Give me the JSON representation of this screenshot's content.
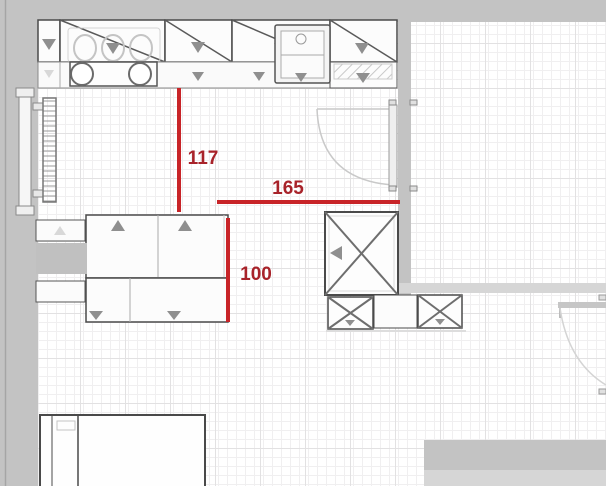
{
  "plan": {
    "dimensions": [
      {
        "label": "117",
        "value": 117,
        "orientation": "vertical"
      },
      {
        "label": "165",
        "value": 165,
        "orientation": "horizontal"
      },
      {
        "label": "100",
        "value": 100,
        "orientation": "vertical"
      }
    ],
    "colors": {
      "dim_line": "#c82428",
      "dim_text": "#a8232a",
      "wall": "#c3c3c3",
      "wall_light": "#d6d6d6",
      "outline_dark": "#4a4a4a",
      "outline_mid": "#8f8f8f",
      "grid_minor": "#f0eff0",
      "grid_major": "#e2e1e2"
    },
    "objects": [
      "top-wall",
      "left-wall",
      "inner-vertical-wall",
      "inner-horizontal-wall",
      "wall-cabinet-row",
      "base-cabinet-row",
      "cooktop",
      "sink",
      "hatched-cabinet",
      "window",
      "radiator",
      "kitchen-island",
      "dishwasher-gray-block",
      "tall-corner-cabinet",
      "lower-x-cabinets",
      "swing-door-top",
      "swing-door-right",
      "table",
      "bottom-right-wall-block"
    ]
  }
}
